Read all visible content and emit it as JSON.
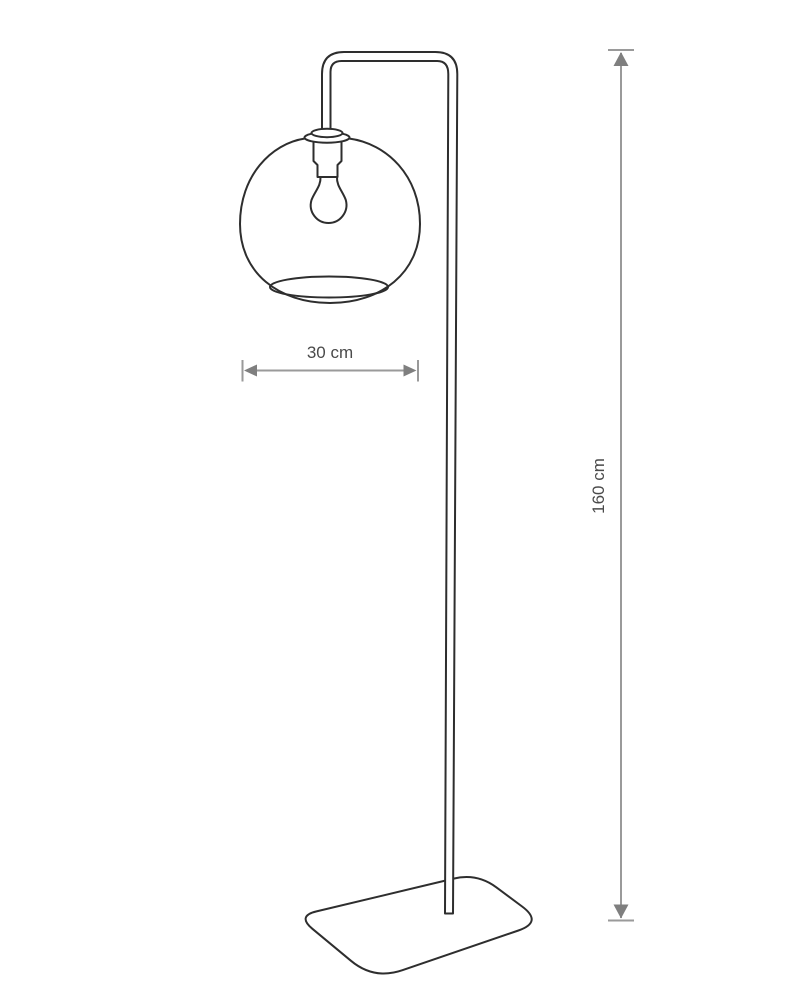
{
  "diagram": {
    "kind": "product-dimension-drawing",
    "subject": "floor-lamp-with-spherical-glass-shade"
  },
  "colors": {
    "background": "#ffffff",
    "lamp_outline": "#2e2e2e",
    "dimension_line": "#9a9a9a",
    "dimension_arrow": "#7f7f7f",
    "dimension_text": "#4a4a4a"
  },
  "dimensions": {
    "shade_width": {
      "label": "30 cm",
      "orientation": "horizontal"
    },
    "lamp_height": {
      "label": "160 cm",
      "orientation": "vertical"
    }
  }
}
